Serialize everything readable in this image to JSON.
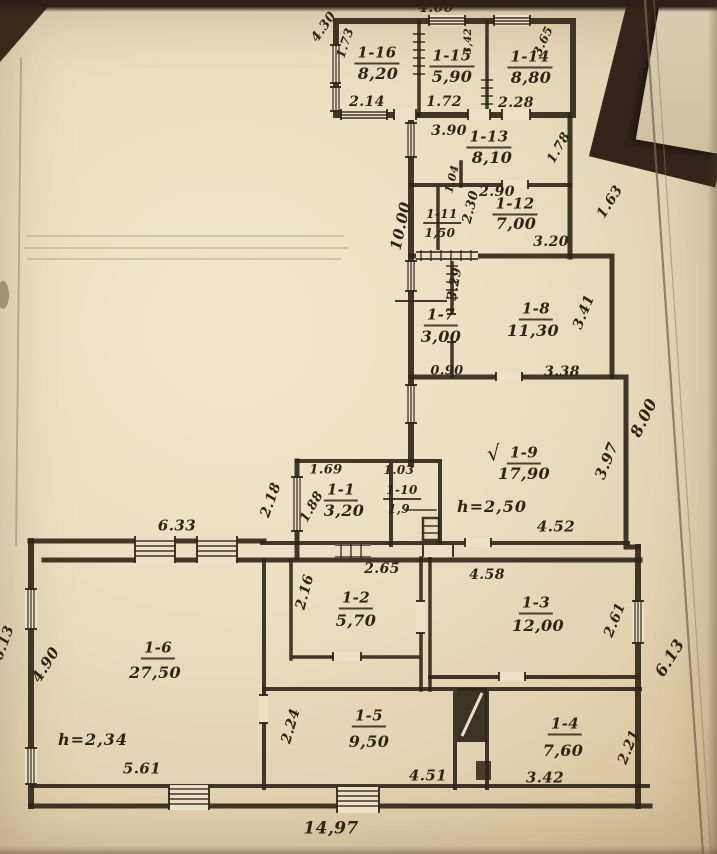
{
  "document": {
    "kind_label": "hand-drawn building floor plan (scanned photo)",
    "ink_color": "#2e2518",
    "paper_color": "#ebdfc2"
  },
  "plan": {
    "rooms": [
      {
        "number": "1-1",
        "area": "3,20"
      },
      {
        "number": "1-2",
        "area": "5,70"
      },
      {
        "number": "1-3",
        "area": "12,00"
      },
      {
        "number": "1-4",
        "area": "7,60"
      },
      {
        "number": "1-5",
        "area": "9,50"
      },
      {
        "number": "1-6",
        "area": "27,50"
      },
      {
        "number": "1-7",
        "area": "3,00"
      },
      {
        "number": "1-8",
        "area": "11,30"
      },
      {
        "number": "1-9",
        "area": "17,90"
      },
      {
        "number": "1-10",
        "area": "1,9"
      },
      {
        "number": "1-11",
        "area": "1,50"
      },
      {
        "number": "1-12",
        "area": "7,00"
      },
      {
        "number": "1-13",
        "area": "8,10"
      },
      {
        "number": "1-14",
        "area": "8,80"
      },
      {
        "number": "1-15",
        "area": "5,90"
      },
      {
        "number": "1-16",
        "area": "8,20"
      }
    ],
    "ceiling_heights": [
      {
        "room": "1-9",
        "label": "h=2,50"
      },
      {
        "room": "1-6",
        "label": "h=2,34"
      }
    ],
    "labels": [
      {
        "name": "room-1-16-number",
        "text": "1-16",
        "x": 377,
        "y": 55,
        "fs": 15,
        "cls": "room-id"
      },
      {
        "name": "room-1-16-area",
        "text": "8,20",
        "x": 378,
        "y": 74,
        "fs": 16,
        "cls": "room-area"
      },
      {
        "name": "room-1-15-number",
        "text": "1-15",
        "x": 452,
        "y": 58,
        "fs": 15,
        "cls": "room-id"
      },
      {
        "name": "room-1-15-area",
        "text": "5,90",
        "x": 452,
        "y": 77,
        "fs": 16,
        "cls": "room-area"
      },
      {
        "name": "room-1-14-number",
        "text": "1-14",
        "x": 530,
        "y": 59,
        "fs": 15,
        "cls": "room-id"
      },
      {
        "name": "room-1-14-area",
        "text": "8,80",
        "x": 531,
        "y": 78,
        "fs": 16,
        "cls": "room-area"
      },
      {
        "name": "room-1-13-number",
        "text": "1-13",
        "x": 489,
        "y": 139,
        "fs": 15,
        "cls": "room-id"
      },
      {
        "name": "room-1-13-area",
        "text": "8,10",
        "x": 492,
        "y": 158,
        "fs": 16,
        "cls": "room-area"
      },
      {
        "name": "room-1-12-number",
        "text": "1-12",
        "x": 515,
        "y": 206,
        "fs": 15,
        "cls": "room-id"
      },
      {
        "name": "room-1-12-area",
        "text": "7,00",
        "x": 516,
        "y": 224,
        "fs": 16,
        "cls": "room-area"
      },
      {
        "name": "room-1-11-number",
        "text": "1-11",
        "x": 442,
        "y": 216,
        "fs": 12,
        "cls": "room-id"
      },
      {
        "name": "room-1-11-area",
        "text": "1,50",
        "x": 440,
        "y": 233,
        "fs": 12,
        "cls": "room-area"
      },
      {
        "name": "room-1-7-number",
        "text": "1-7",
        "x": 441,
        "y": 317,
        "fs": 15,
        "cls": "room-id"
      },
      {
        "name": "room-1-7-area",
        "text": "3,00",
        "x": 441,
        "y": 337,
        "fs": 16,
        "cls": "room-area"
      },
      {
        "name": "room-1-8-number",
        "text": "1-8",
        "x": 536,
        "y": 311,
        "fs": 15,
        "cls": "room-id"
      },
      {
        "name": "room-1-8-area",
        "text": "11,30",
        "x": 533,
        "y": 331,
        "fs": 16,
        "cls": "room-area"
      },
      {
        "name": "room-1-9-number",
        "text": "1-9",
        "x": 524,
        "y": 455,
        "fs": 15,
        "cls": "room-id"
      },
      {
        "name": "room-1-9-area",
        "text": "17,90",
        "x": 524,
        "y": 474,
        "fs": 16,
        "cls": "room-area"
      },
      {
        "name": "room-1-9-checkmark",
        "text": "√",
        "x": 494,
        "y": 454,
        "fs": 21,
        "rot": -6,
        "cls": "mark"
      },
      {
        "name": "room-1-1-number",
        "text": "1-1",
        "x": 341,
        "y": 492,
        "fs": 15,
        "cls": "room-id"
      },
      {
        "name": "room-1-1-area",
        "text": "3,20",
        "x": 344,
        "y": 511,
        "fs": 16,
        "cls": "room-area"
      },
      {
        "name": "room-1-10-number",
        "text": "1-10",
        "x": 402,
        "y": 492,
        "fs": 12,
        "cls": "room-id"
      },
      {
        "name": "room-1-10-area",
        "text": "1,9",
        "x": 399,
        "y": 509,
        "fs": 12,
        "cls": "room-area"
      },
      {
        "name": "room-1-2-number",
        "text": "1-2",
        "x": 356,
        "y": 600,
        "fs": 15,
        "cls": "room-id"
      },
      {
        "name": "room-1-2-area",
        "text": "5,70",
        "x": 356,
        "y": 621,
        "fs": 16,
        "cls": "room-area"
      },
      {
        "name": "room-1-3-number",
        "text": "1-3",
        "x": 536,
        "y": 605,
        "fs": 15,
        "cls": "room-id"
      },
      {
        "name": "room-1-3-area",
        "text": "12,00",
        "x": 538,
        "y": 626,
        "fs": 16,
        "cls": "room-area"
      },
      {
        "name": "room-1-6-number",
        "text": "1-6",
        "x": 158,
        "y": 650,
        "fs": 15,
        "cls": "room-id"
      },
      {
        "name": "room-1-6-area",
        "text": "27,50",
        "x": 155,
        "y": 673,
        "fs": 16,
        "cls": "room-area"
      },
      {
        "name": "room-1-5-number",
        "text": "1-5",
        "x": 369,
        "y": 718,
        "fs": 15,
        "cls": "room-id"
      },
      {
        "name": "room-1-5-area",
        "text": "9,50",
        "x": 369,
        "y": 742,
        "fs": 16,
        "cls": "room-area"
      },
      {
        "name": "room-1-4-number",
        "text": "1-4",
        "x": 565,
        "y": 726,
        "fs": 15,
        "cls": "room-id"
      },
      {
        "name": "room-1-4-area",
        "text": "7,60",
        "x": 563,
        "y": 751,
        "fs": 16,
        "cls": "room-area"
      },
      {
        "name": "height-room-1-9",
        "text": "h=2,50",
        "x": 492,
        "y": 507,
        "fs": 16,
        "cls": "height"
      },
      {
        "name": "height-room-1-6",
        "text": "h=2,34",
        "x": 93,
        "y": 740,
        "fs": 16,
        "cls": "height"
      },
      {
        "name": "dim-4-00",
        "text": "4.00",
        "x": 436,
        "y": 8,
        "fs": 14,
        "cls": "dim"
      },
      {
        "name": "dim-4-30",
        "text": "4.30",
        "x": 324,
        "y": 27,
        "fs": 13,
        "rot": -55,
        "cls": "dim"
      },
      {
        "name": "dim-1-73",
        "text": "1.73",
        "x": 345,
        "y": 43,
        "fs": 12,
        "rot": -72,
        "cls": "dim"
      },
      {
        "name": "dim-3-42-top",
        "text": "3,42",
        "x": 469,
        "y": 41,
        "fs": 10,
        "rot": -90,
        "cls": "dim"
      },
      {
        "name": "dim-3-65",
        "text": "3.65",
        "x": 543,
        "y": 41,
        "fs": 12,
        "rot": -65,
        "cls": "dim"
      },
      {
        "name": "dim-2-14",
        "text": "2.14",
        "x": 367,
        "y": 102,
        "fs": 14,
        "cls": "dim"
      },
      {
        "name": "dim-1-72",
        "text": "1.72",
        "x": 444,
        "y": 102,
        "fs": 14,
        "cls": "dim"
      },
      {
        "name": "dim-2-28",
        "text": "2.28",
        "x": 516,
        "y": 103,
        "fs": 14,
        "cls": "dim"
      },
      {
        "name": "dim-3-90",
        "text": "3.90",
        "x": 449,
        "y": 131,
        "fs": 14,
        "cls": "dim"
      },
      {
        "name": "dim-1-78",
        "text": "1.78",
        "x": 559,
        "y": 148,
        "fs": 13,
        "rot": -60,
        "cls": "dim"
      },
      {
        "name": "dim-1-63",
        "text": "1.63",
        "x": 610,
        "y": 202,
        "fs": 14,
        "rot": -58,
        "cls": "dim"
      },
      {
        "name": "dim-10-00",
        "text": "10.00",
        "x": 401,
        "y": 226,
        "fs": 15,
        "rot": -78,
        "cls": "dim"
      },
      {
        "name": "dim-2-90",
        "text": "2.90",
        "x": 497,
        "y": 192,
        "fs": 14,
        "cls": "dim"
      },
      {
        "name": "dim-1-04",
        "text": "1.04",
        "x": 452,
        "y": 179,
        "fs": 11,
        "rot": -76,
        "cls": "dim"
      },
      {
        "name": "dim-2-30",
        "text": "2.30",
        "x": 471,
        "y": 207,
        "fs": 13,
        "rot": -76,
        "cls": "dim"
      },
      {
        "name": "dim-3-20",
        "text": "3.20",
        "x": 551,
        "y": 242,
        "fs": 14,
        "cls": "dim"
      },
      {
        "name": "dim-3-29",
        "text": "3.29",
        "x": 455,
        "y": 284,
        "fs": 13,
        "rot": -80,
        "cls": "dim"
      },
      {
        "name": "dim-0-90",
        "text": "0.90",
        "x": 447,
        "y": 371,
        "fs": 13,
        "cls": "dim"
      },
      {
        "name": "dim-3-38",
        "text": "3.38",
        "x": 562,
        "y": 372,
        "fs": 14,
        "cls": "dim"
      },
      {
        "name": "dim-3-41",
        "text": "3.41",
        "x": 584,
        "y": 312,
        "fs": 14,
        "rot": -68,
        "cls": "dim"
      },
      {
        "name": "dim-3-97",
        "text": "3.97",
        "x": 607,
        "y": 461,
        "fs": 15,
        "rot": -68,
        "cls": "dim"
      },
      {
        "name": "dim-8-00",
        "text": "8.00",
        "x": 644,
        "y": 418,
        "fs": 16,
        "rot": -64,
        "cls": "dim"
      },
      {
        "name": "dim-4-52",
        "text": "4.52",
        "x": 556,
        "y": 527,
        "fs": 15,
        "cls": "dim"
      },
      {
        "name": "dim-1-69",
        "text": "1.69",
        "x": 326,
        "y": 470,
        "fs": 13,
        "cls": "dim"
      },
      {
        "name": "dim-1-03",
        "text": "1.03",
        "x": 399,
        "y": 470,
        "fs": 12,
        "cls": "dim"
      },
      {
        "name": "dim-1-88",
        "text": "1.88",
        "x": 312,
        "y": 507,
        "fs": 13,
        "rot": -60,
        "cls": "dim"
      },
      {
        "name": "dim-2-18",
        "text": "2.18",
        "x": 271,
        "y": 500,
        "fs": 14,
        "rot": -70,
        "cls": "dim"
      },
      {
        "name": "dim-6-33",
        "text": "6.33",
        "x": 177,
        "y": 526,
        "fs": 15,
        "cls": "dim"
      },
      {
        "name": "dim-2-65",
        "text": "2.65",
        "x": 382,
        "y": 569,
        "fs": 14,
        "cls": "dim"
      },
      {
        "name": "dim-2-16",
        "text": "2.16",
        "x": 305,
        "y": 592,
        "fs": 14,
        "rot": -75,
        "cls": "dim"
      },
      {
        "name": "dim-4-58",
        "text": "4.58",
        "x": 487,
        "y": 575,
        "fs": 14,
        "cls": "dim"
      },
      {
        "name": "dim-2-61",
        "text": "2.61",
        "x": 615,
        "y": 620,
        "fs": 14,
        "rot": -68,
        "cls": "dim"
      },
      {
        "name": "dim-6-13-right",
        "text": "6.13",
        "x": 670,
        "y": 658,
        "fs": 16,
        "rot": -58,
        "cls": "dim"
      },
      {
        "name": "dim-6-13-left",
        "text": "6.13",
        "x": 4,
        "y": 643,
        "fs": 14,
        "rot": -70,
        "cls": "dim"
      },
      {
        "name": "dim-4-90",
        "text": "4.90",
        "x": 46,
        "y": 665,
        "fs": 15,
        "rot": -58,
        "cls": "dim"
      },
      {
        "name": "dim-5-61",
        "text": "5.61",
        "x": 142,
        "y": 769,
        "fs": 15,
        "cls": "dim"
      },
      {
        "name": "dim-2-24",
        "text": "2.24",
        "x": 291,
        "y": 726,
        "fs": 14,
        "rot": -74,
        "cls": "dim"
      },
      {
        "name": "dim-4-51",
        "text": "4.51",
        "x": 428,
        "y": 776,
        "fs": 15,
        "cls": "dim"
      },
      {
        "name": "dim-3-42-bottom",
        "text": "3.42",
        "x": 545,
        "y": 778,
        "fs": 15,
        "cls": "dim"
      },
      {
        "name": "dim-2-21",
        "text": "2.21",
        "x": 629,
        "y": 747,
        "fs": 14,
        "rot": -68,
        "cls": "dim"
      },
      {
        "name": "dim-14-97",
        "text": "14,97",
        "x": 331,
        "y": 829,
        "fs": 17,
        "cls": "dim"
      }
    ]
  }
}
